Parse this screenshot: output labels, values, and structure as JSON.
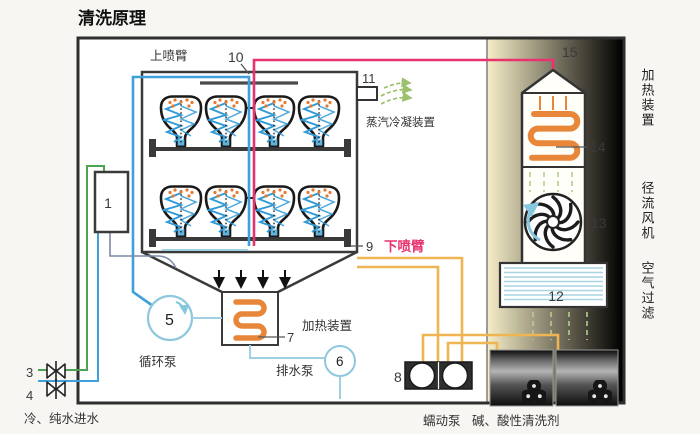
{
  "title": "清洗原理",
  "labels": {
    "upper_spray_arm": "上喷臂",
    "lower_spray_arm": "下喷臂",
    "steam_condenser": "蒸汽冷凝装置",
    "sump_heater": "加热装置",
    "tower_heater": "加热装置",
    "radial_fan": "径流风机",
    "air_filter": "空气过滤",
    "circulation_pump": "循环泵",
    "drain_pump": "排水泵",
    "peristaltic_pump": "蠕动泵",
    "detergent": "碱、酸性清洗剂",
    "water_inlet": "冷、纯水进水"
  },
  "numbers": {
    "n1": "1",
    "n3": "3",
    "n4": "4",
    "n5": "5",
    "n6": "6",
    "n7": "7",
    "n8": "8",
    "n9": "9",
    "n10": "10",
    "n11": "11",
    "n12": "12",
    "n13": "13",
    "n14": "14",
    "n15": "15"
  },
  "colors": {
    "pink": "#e8336e",
    "blue": "#3fa0dc",
    "green": "#4ea352",
    "tube": "#f0b553",
    "lightblue": "#9fd0e2",
    "coil": "#e8873a",
    "panel": "#f3e3a8"
  }
}
